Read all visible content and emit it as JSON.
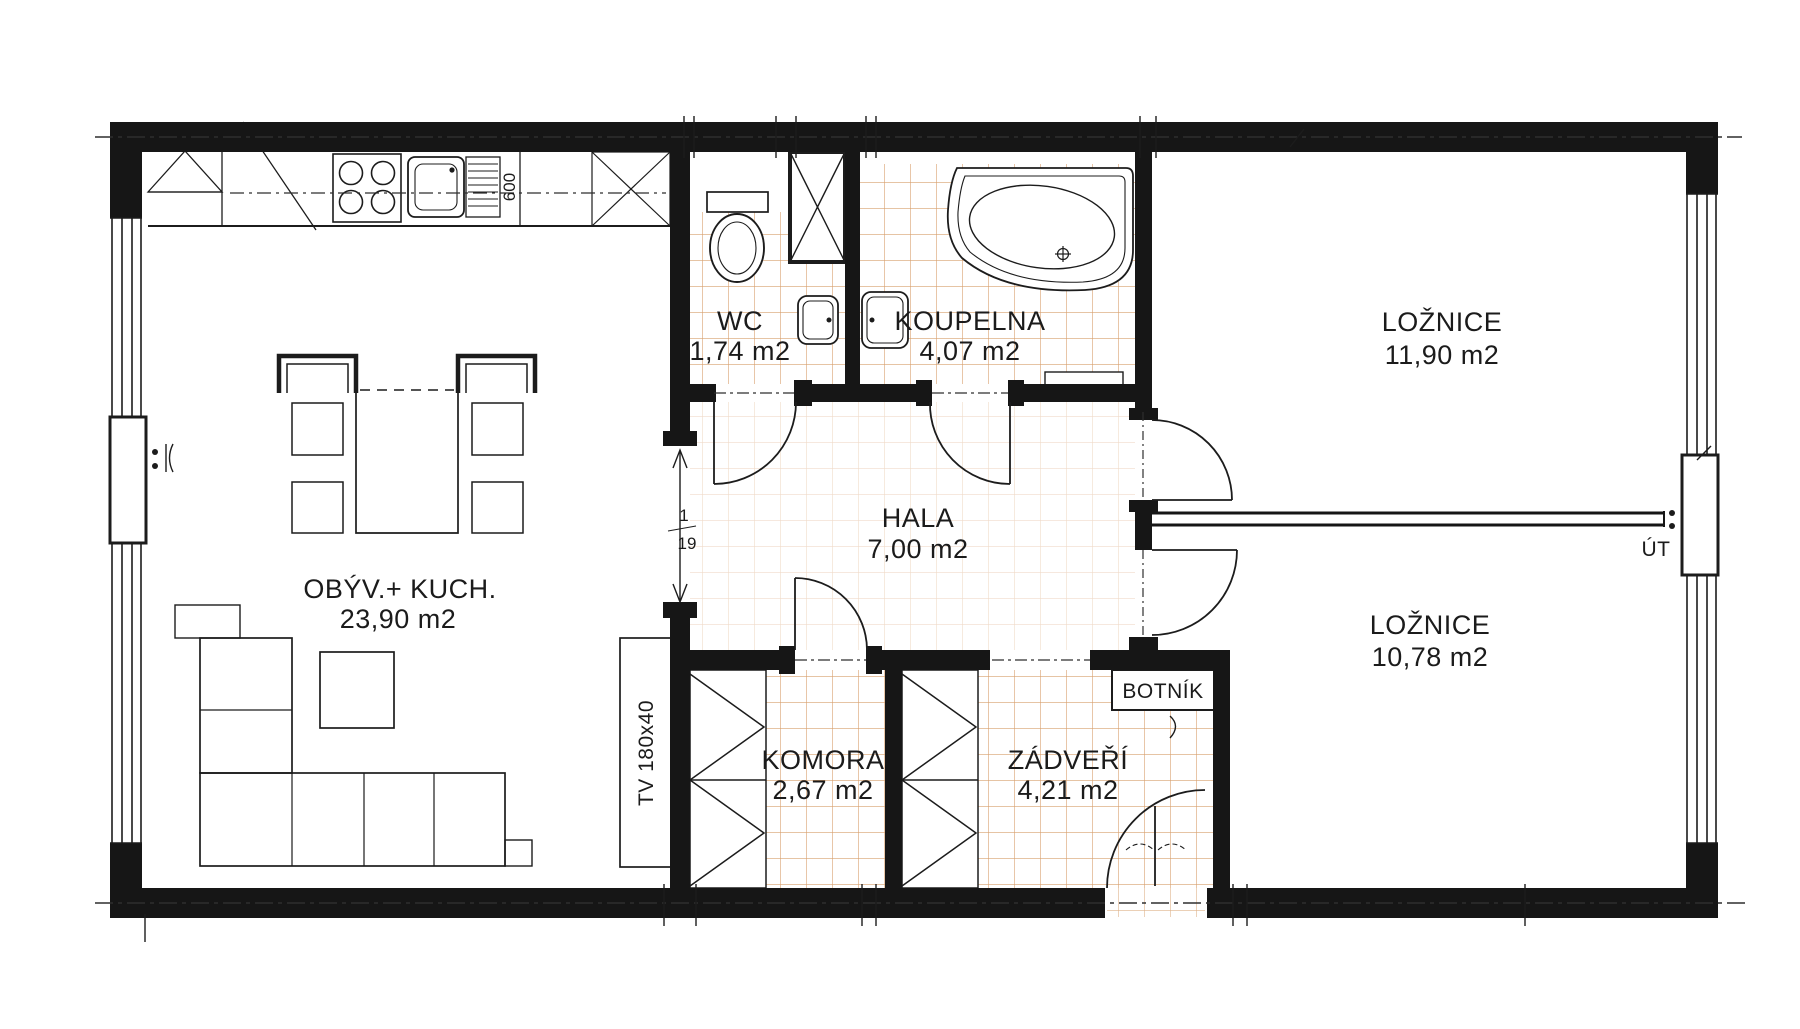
{
  "rooms": {
    "living_kitchen": {
      "name": "OBÝV.+ KUCH.",
      "area": "23,90 m2"
    },
    "wc": {
      "name": "WC",
      "area": "1,74 m2"
    },
    "bathroom": {
      "name": "KOUPELNA",
      "area": "4,07 m2"
    },
    "hall": {
      "name": "HALA",
      "area": "7,00 m2"
    },
    "bedroom_top": {
      "name": "LOŽNICE",
      "area": "11,90 m2"
    },
    "bedroom_bottom": {
      "name": "LOŽNICE",
      "area": "10,78 m2"
    },
    "closet": {
      "name": "KOMORA",
      "area": "2,67 m2"
    },
    "vestibule": {
      "name": "ZÁDVEŘÍ",
      "area": "4,21 m2"
    }
  },
  "annotations": {
    "shoe_cabinet": "BOTNÍK",
    "tv_unit": "TV 180x40",
    "central_heating": "ÚT",
    "kitchen_module_width": "600",
    "opening_dim_upper": "1",
    "opening_dim_lower": "19"
  },
  "colors": {
    "line": "#1b1b1b",
    "tile": "#c9803e"
  }
}
